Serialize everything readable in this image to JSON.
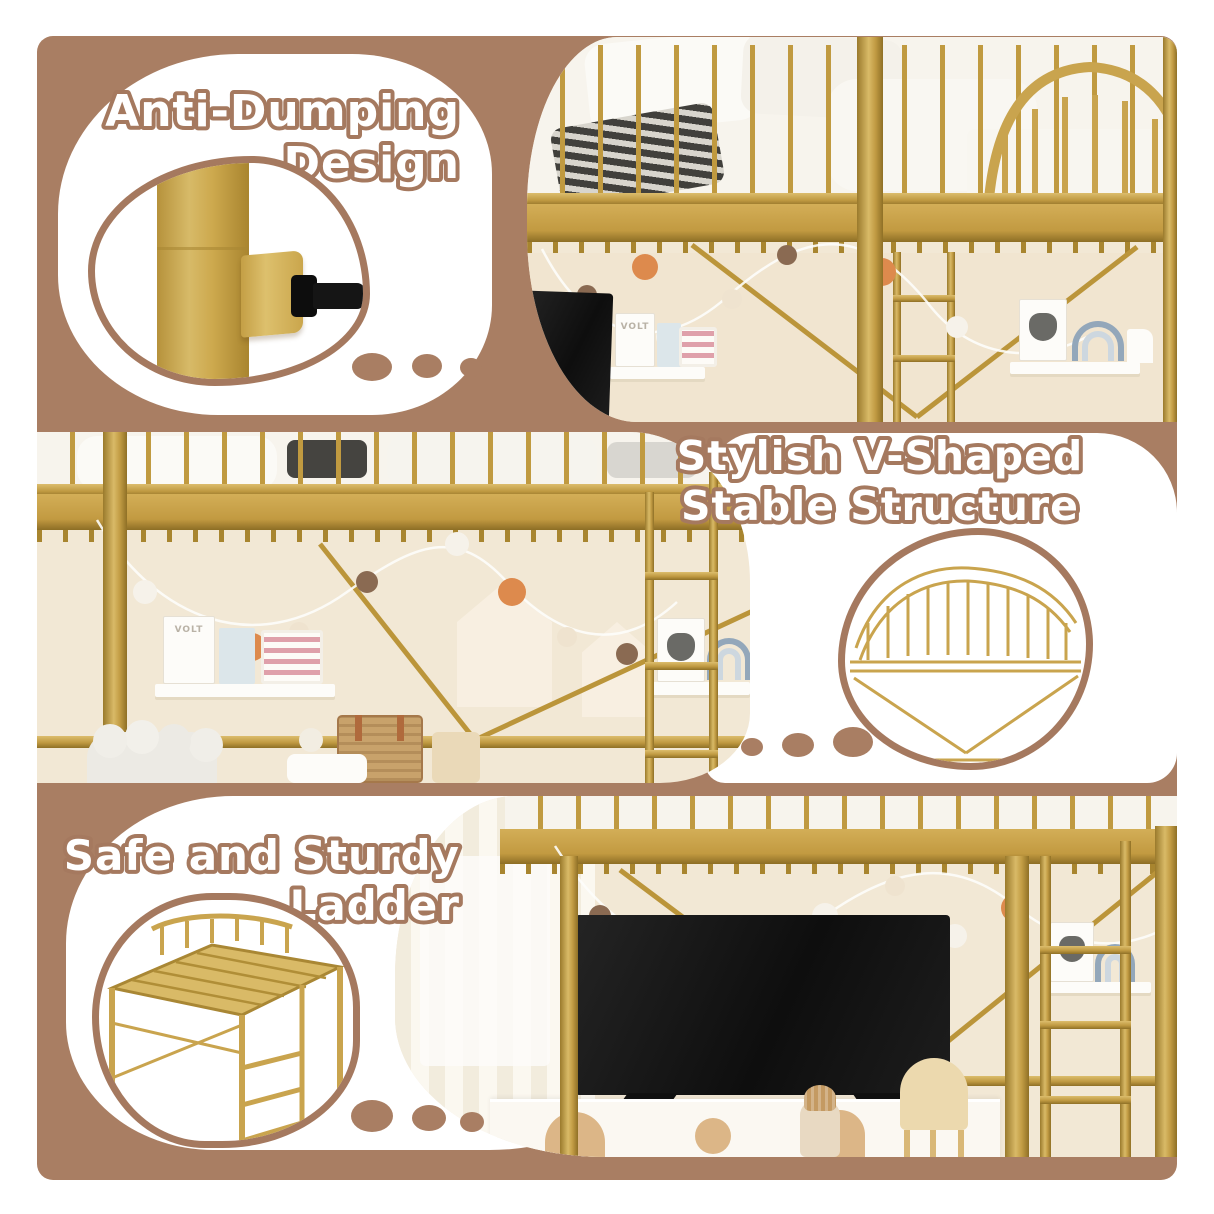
{
  "colors": {
    "canvas_brown": "#a97e63",
    "outline_brown": "#a5795f",
    "frame_gold": "#c9a44e",
    "wall_cream": "#f2e8d5",
    "white": "#ffffff"
  },
  "sections": [
    {
      "id": "anti-dumping",
      "line1": "Anti-Dumping",
      "line2": "Design"
    },
    {
      "id": "v-shaped",
      "line1": "Stylish V-Shaped",
      "line2": "Stable Structure"
    },
    {
      "id": "ladder",
      "line1": "Safe and Sturdy",
      "line2": "Ladder"
    }
  ],
  "photo_labels": {
    "book_spine": "VOLT"
  }
}
